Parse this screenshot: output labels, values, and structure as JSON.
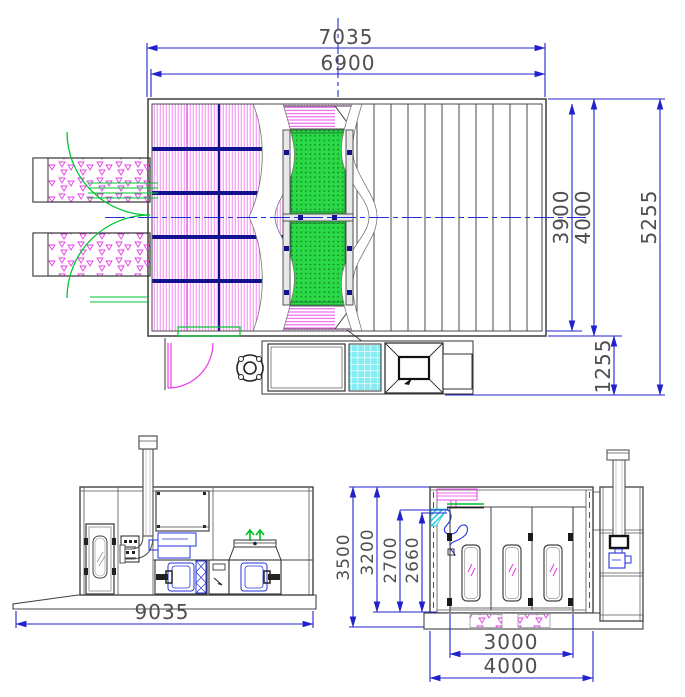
{
  "drawing": {
    "type": "spray booth general arrangement drawing",
    "views": [
      "plan view",
      "side elevation",
      "front elevation"
    ]
  },
  "plan": {
    "dims": {
      "overall_width": "7035",
      "inner_width": "6900",
      "inner_depth": "3900",
      "booth_depth": "4000",
      "overall_depth": "5255",
      "machine_bay_depth": "1255"
    }
  },
  "side": {
    "dims": {
      "overall_length": "9035"
    }
  },
  "front": {
    "dims": {
      "overall_height": "3500",
      "body_height": "3200",
      "inner_height_a": "2700",
      "inner_height_b": "2660",
      "door_opening_width": "3000",
      "overall_width": "4000"
    }
  },
  "colors": {
    "dimension_blue": "#2222cd",
    "hatch_magenta": "#ee3cee",
    "grating_green": "#2bd846",
    "frame_navy": "#12128e",
    "duct_cyan": "#86ecf2",
    "door_swing_green": "#00c532",
    "line_dark": "#444444",
    "text_gray": "#4f4f4f"
  }
}
